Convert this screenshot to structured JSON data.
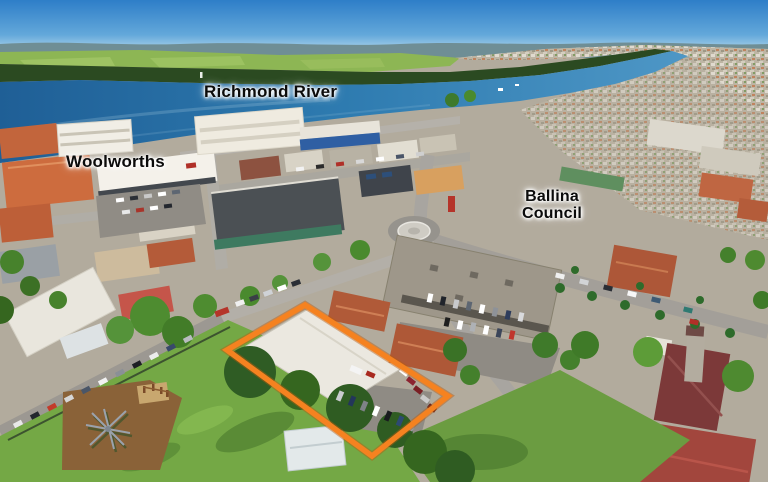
{
  "labels": {
    "richmond_river": "Richmond River",
    "woolworths": "Woolworths",
    "ballina_council_line1": "Ballina",
    "ballina_council_line2": "Council"
  },
  "highlight": {
    "color": "#F58220"
  },
  "palette": {
    "sky_top": "#2E7EC8",
    "sky_horizon": "#CFE8F2",
    "river_deep": "#1F5F96",
    "river_mid": "#2E7BB0",
    "river_light": "#4E97C6",
    "farmland": "#8DB654",
    "treeline": "#2B4A21",
    "town_base": "#B2AB9D",
    "park_lawn": "#74A845",
    "playground_mulch": "#8A6238"
  }
}
